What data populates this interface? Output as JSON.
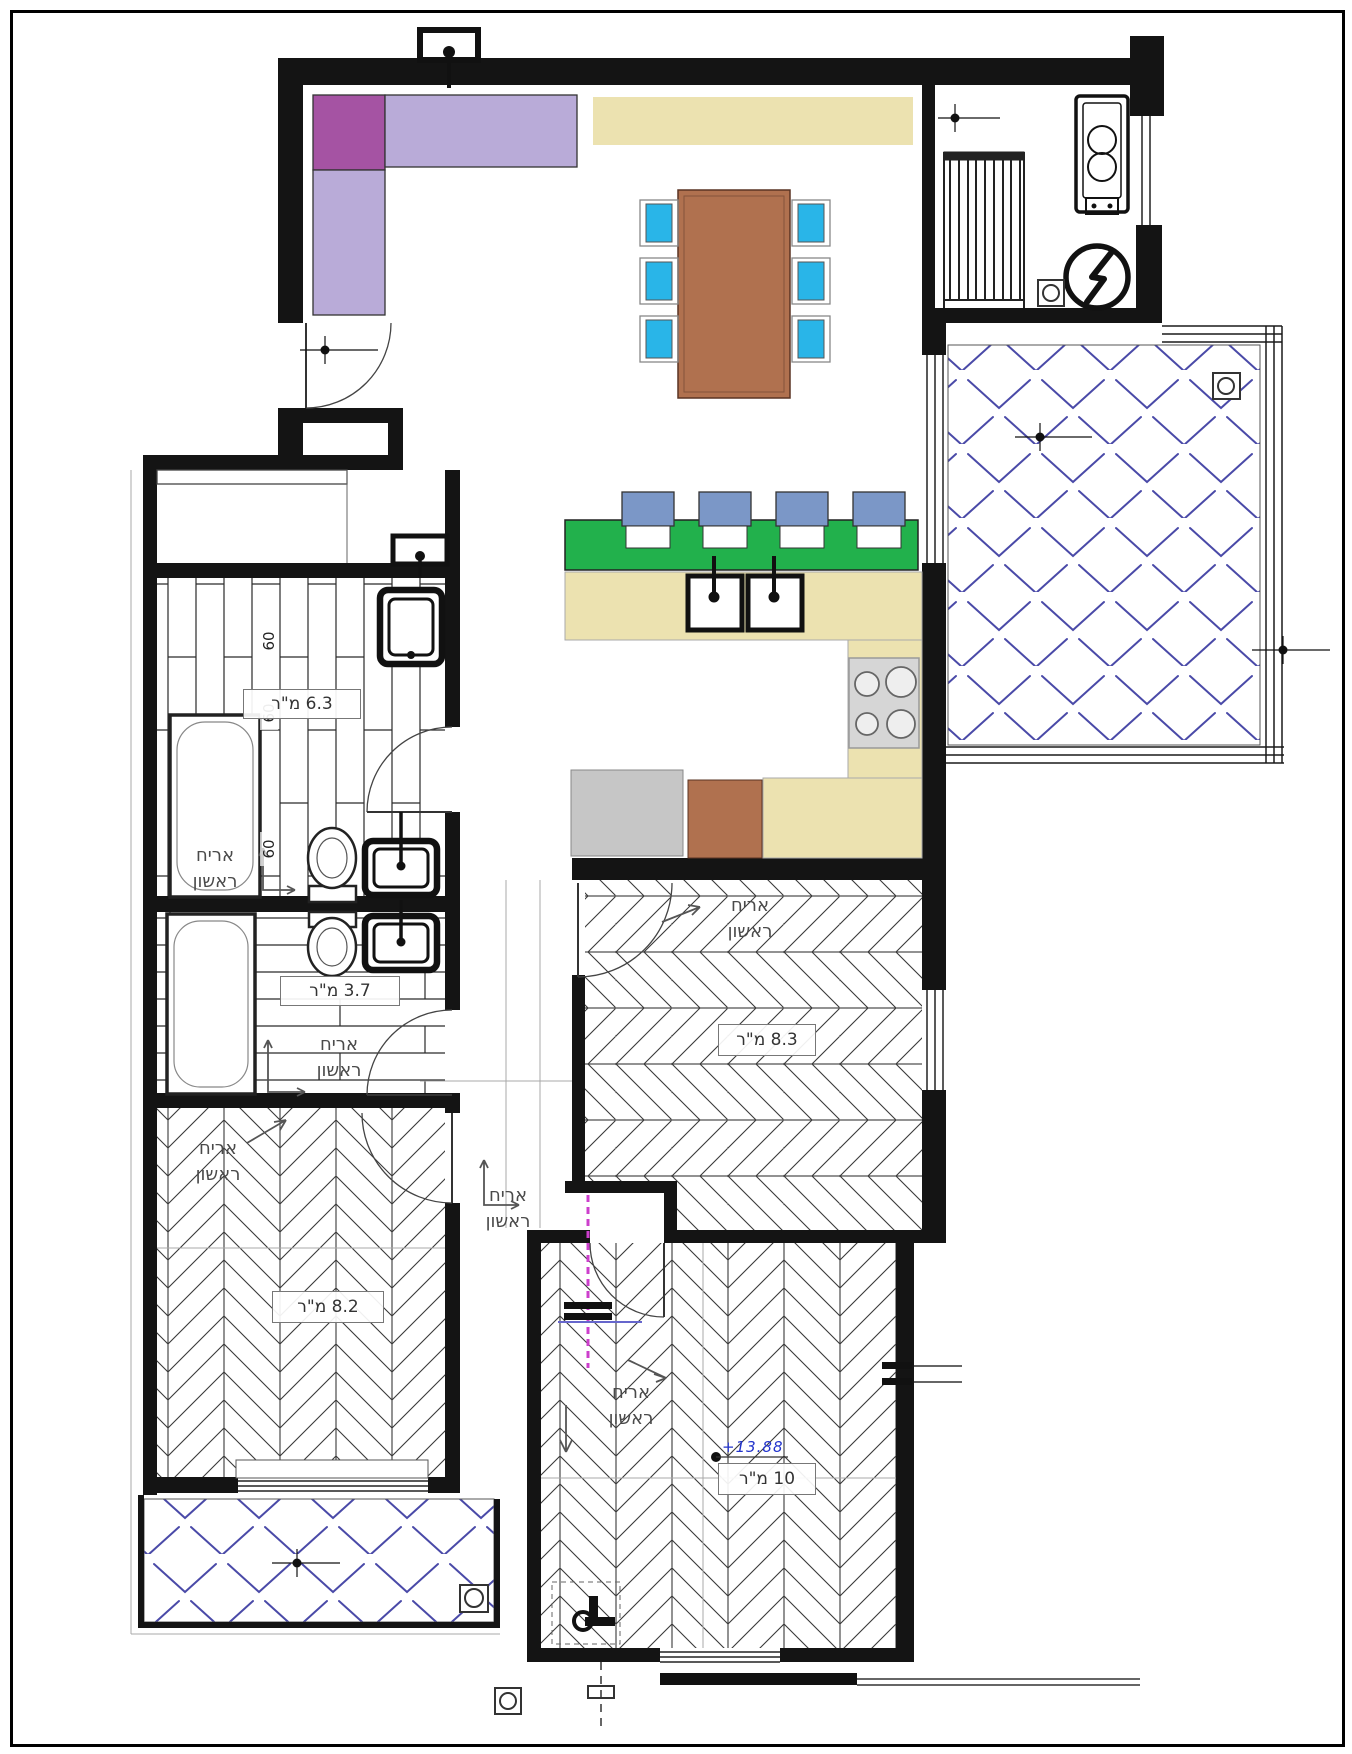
{
  "plan": {
    "area_labels": {
      "bathroom_large": "6.3 מ\"ר",
      "bathroom_small": "3.7 מ\"ר",
      "bedroom_middle": "8.3 מ\"ר",
      "bedroom_left": "8.2 מ\"ר",
      "bedroom_bottom": "10 מ\"ר"
    },
    "annotations": {
      "first_tile_word1": "אריח",
      "first_tile_word2": "ראשון",
      "tile_size": "60",
      "elevation_mark": "+13.88"
    },
    "colors": {
      "sofa": "#b9abd8",
      "sofa_corner": "#a553a3",
      "counter": "#ece2b0",
      "island": "#22b14c",
      "stool": "#7b97c7",
      "chair": "#29b5e8",
      "table": "#b0714f",
      "appliance": "#c6c6c6",
      "appliance_brown": "#b0714f",
      "tile_hatch": "#4a4aa8",
      "section_line": "#cc3fcc",
      "elevation_text": "#2233cc"
    }
  }
}
